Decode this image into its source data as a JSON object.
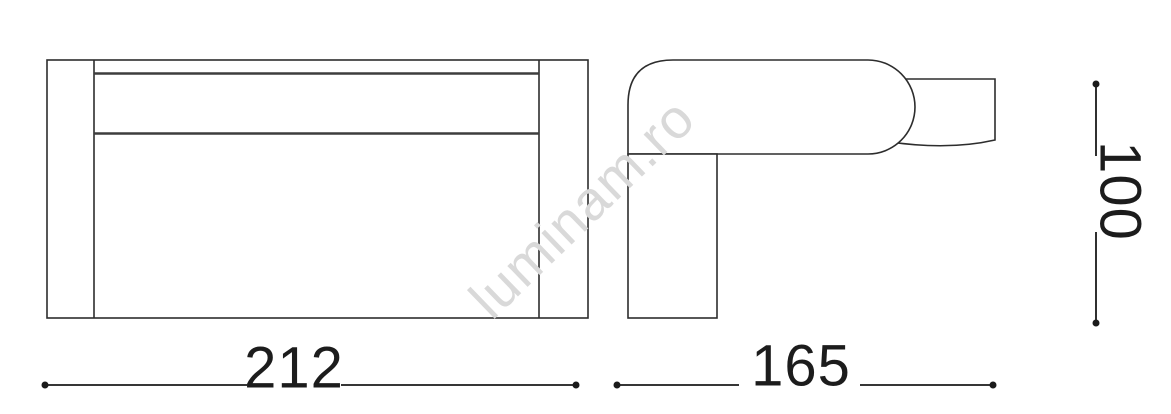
{
  "drawing": {
    "kind": "technical dimension drawing of a wall light fixture, front and side views",
    "background_color": "#ffffff",
    "line_color": "#2d2d2d",
    "inner_line_color": "#3d3d3d",
    "dimension_text_color": "#1c1c1c",
    "dimensions": {
      "width": "212",
      "depth": "165",
      "height": "100"
    },
    "watermark": {
      "text": "luminam.ro",
      "color": "#d9d9d9"
    }
  }
}
